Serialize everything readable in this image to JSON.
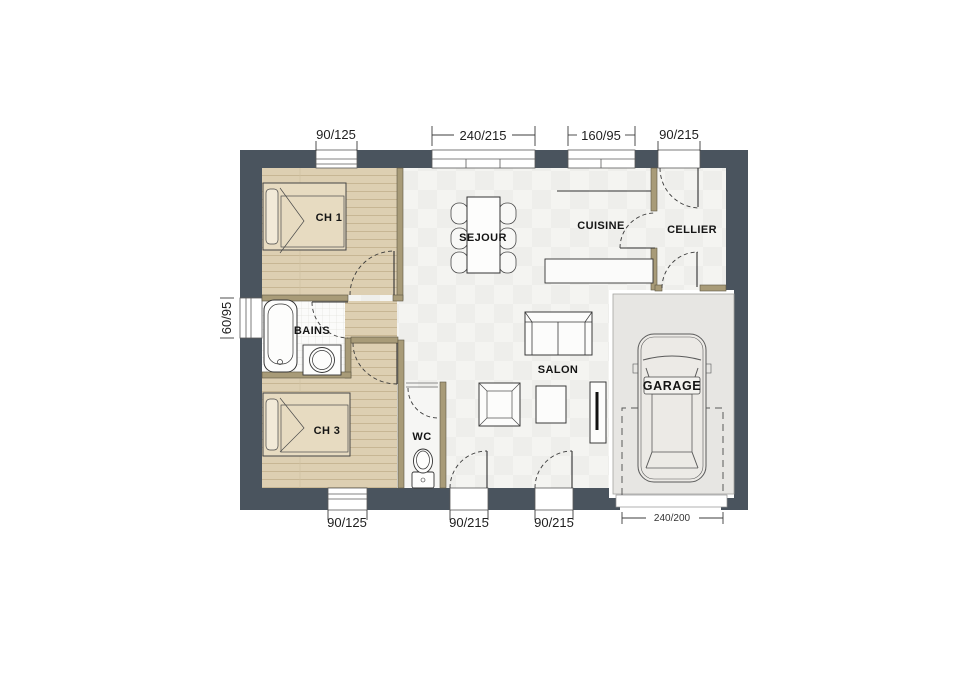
{
  "plan": {
    "rooms": {
      "ch1": "CH 1",
      "sejour": "SEJOUR",
      "cuisine": "CUISINE",
      "cellier": "CELLIER",
      "bains": "BAINS",
      "ch3": "CH 3",
      "wc": "WC",
      "salon": "SALON",
      "garage": "GARAGE"
    },
    "dims": {
      "top": [
        "90/125",
        "240/215",
        "160/95",
        "90/215"
      ],
      "left": [
        "60/95"
      ],
      "bottom": [
        "90/125",
        "90/215",
        "90/215"
      ],
      "garage_door": "240/200"
    },
    "colors": {
      "wall": "#4a545e",
      "wood_floor": "#ddcfb2",
      "partition": "#a89b78",
      "garage_floor": "#e7e6e3",
      "tile_floor": "#fbfbfa"
    }
  }
}
